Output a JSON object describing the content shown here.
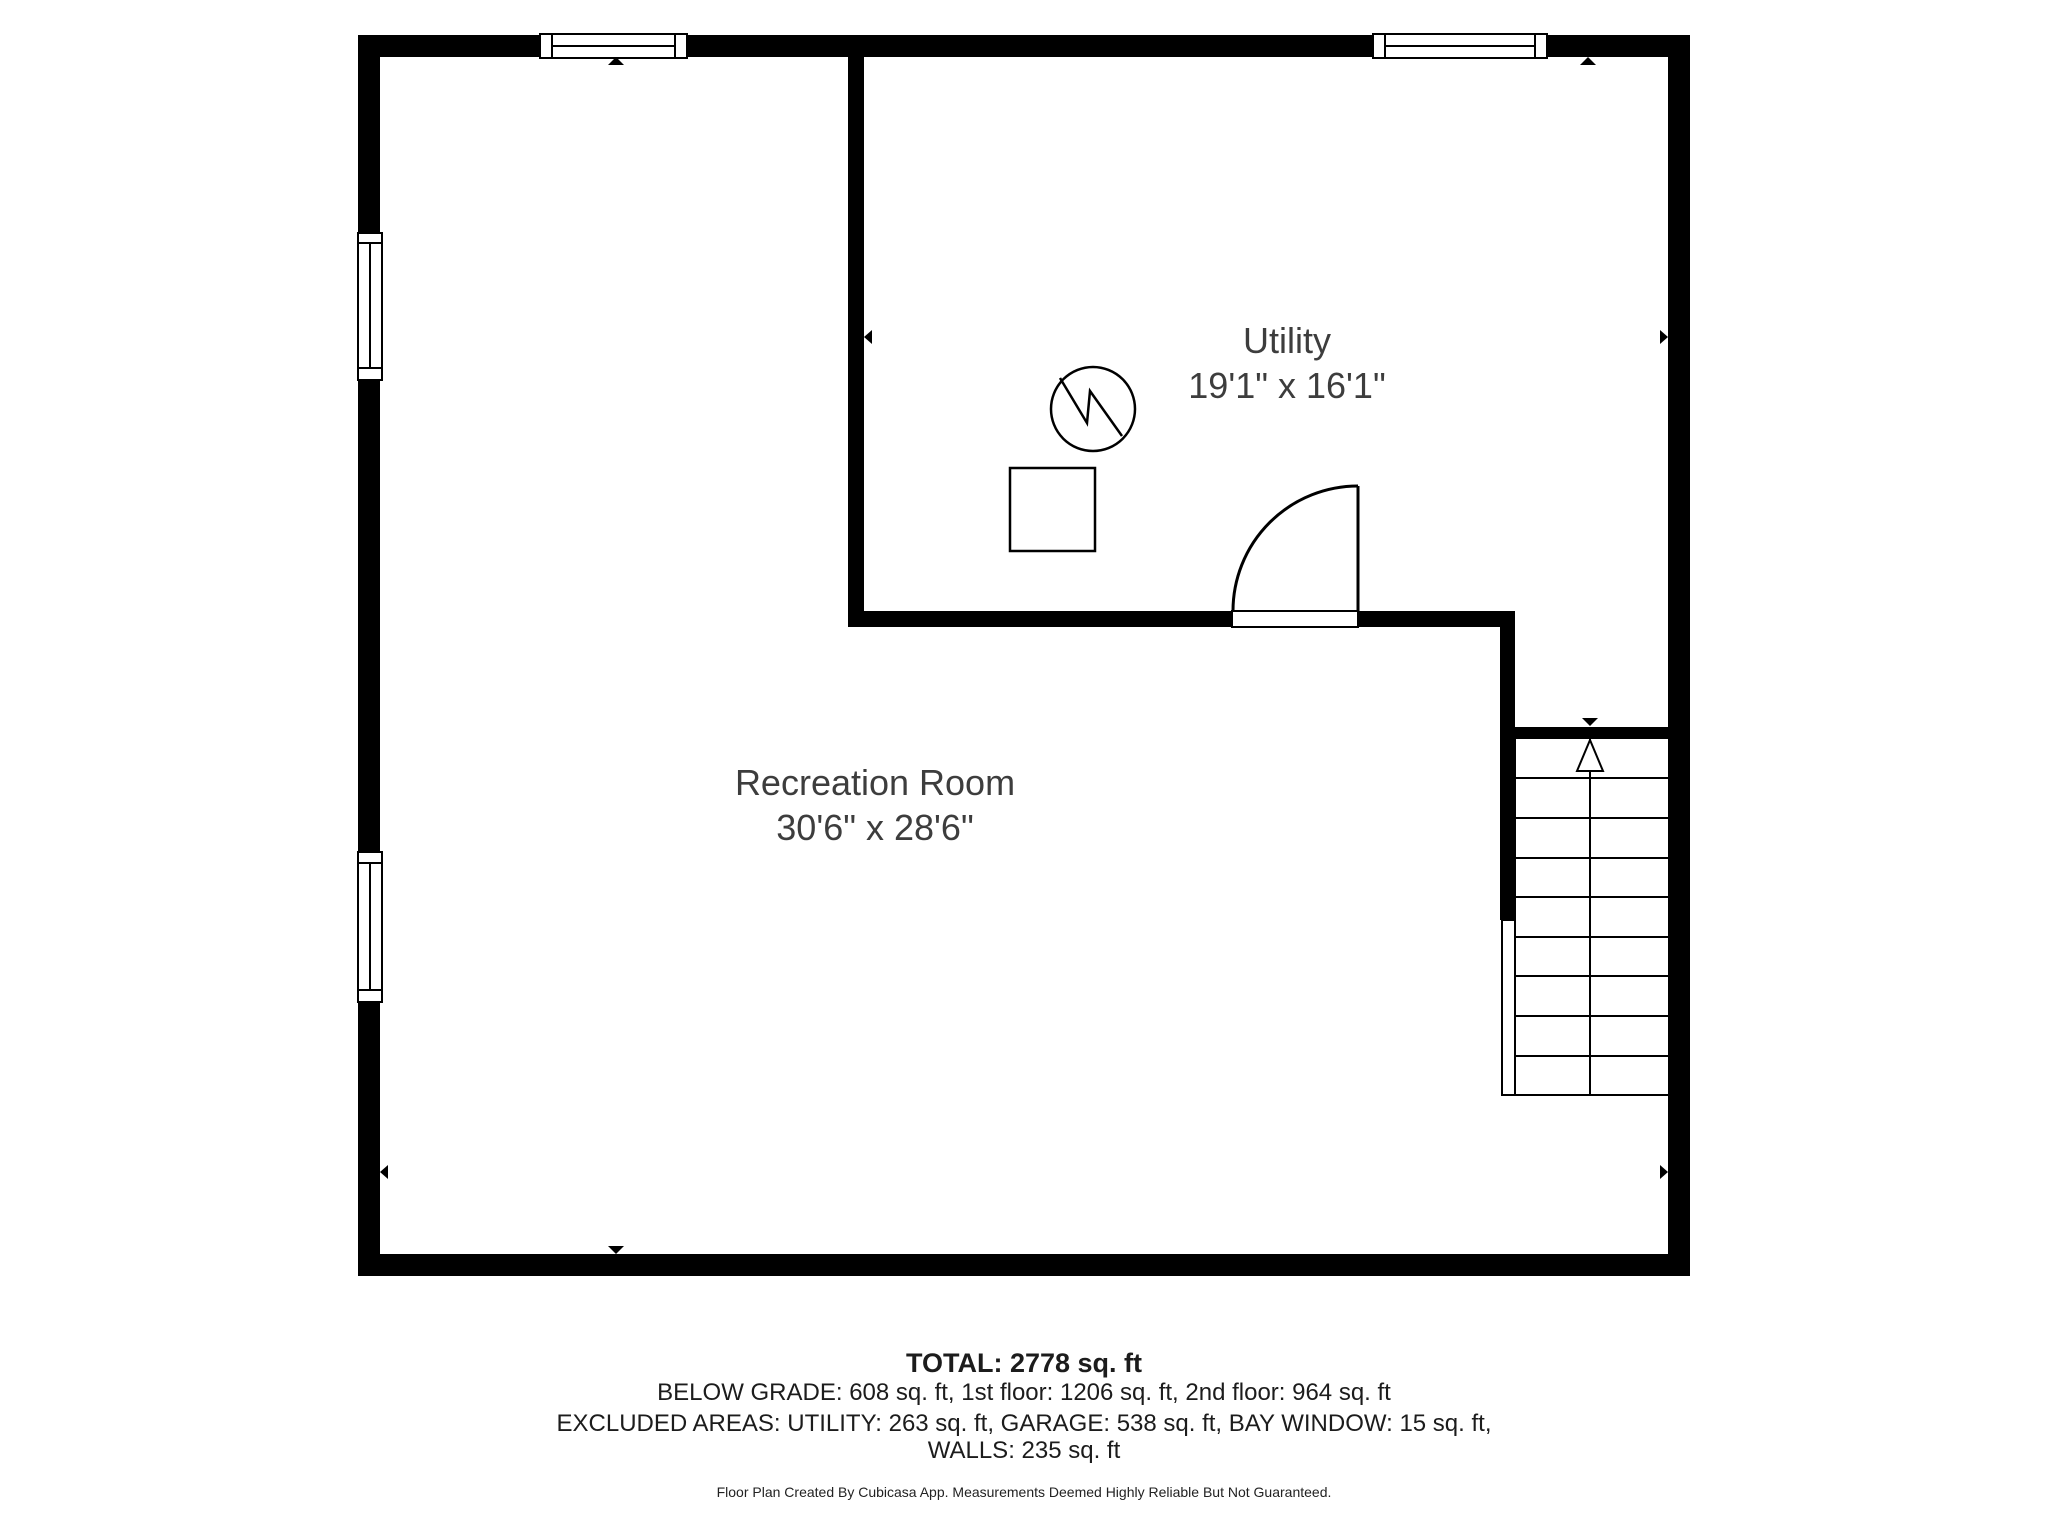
{
  "page": {
    "background_color": "#ffffff",
    "wall_color": "#000000",
    "label_color": "#3d3d3d"
  },
  "floor_plan": {
    "rooms": [
      {
        "name": "Utility",
        "dimensions": "19'1\" x 16'1\""
      },
      {
        "name": "Recreation Room",
        "dimensions": "30'6\" x 28'6\""
      }
    ],
    "symbols": [
      "water-heater-icon",
      "furnace-icon",
      "door-swing-arc",
      "staircase-up-arrow",
      "window-icon",
      "dimension-arrow"
    ]
  },
  "summary": {
    "total": "TOTAL: 2778 sq. ft",
    "floors": "BELOW GRADE: 608 sq. ft, 1st floor: 1206 sq. ft, 2nd floor: 964 sq. ft",
    "excluded": "EXCLUDED AREAS: UTILITY: 263 sq. ft, GARAGE: 538 sq. ft, BAY WINDOW: 15 sq. ft,",
    "walls": "WALLS: 235 sq. ft",
    "disclaimer": "Floor Plan Created By Cubicasa App. Measurements Deemed Highly Reliable But Not Guaranteed."
  }
}
